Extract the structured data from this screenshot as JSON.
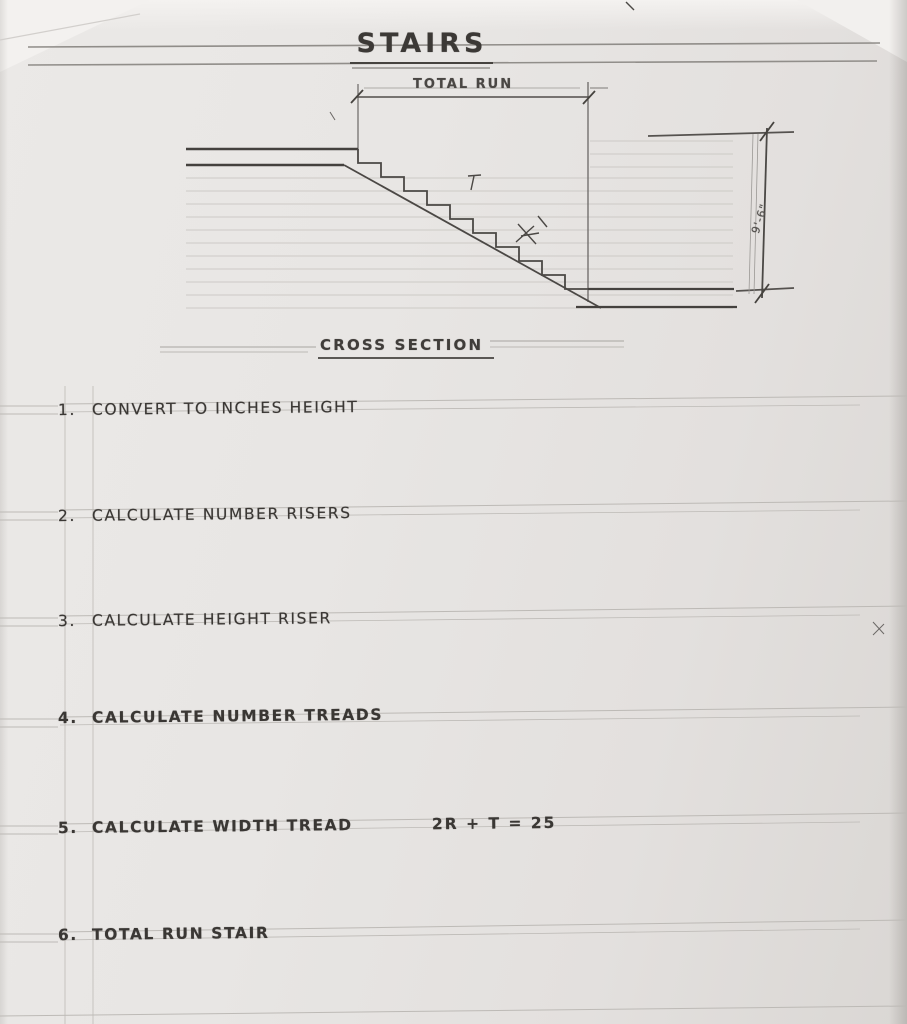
{
  "page": {
    "title": "STAIRS"
  },
  "drawing": {
    "total_run_label": "TOTAL RUN",
    "rise_label": "9'-6\"",
    "caption": "CROSS SECTION"
  },
  "list": {
    "items": [
      {
        "num": "1.",
        "text": "CONVERT TO INCHES HEIGHT"
      },
      {
        "num": "2.",
        "text": "CALCULATE NUMBER RISERS"
      },
      {
        "num": "3.",
        "text": "CALCULATE HEIGHT RISER"
      },
      {
        "num": "4.",
        "text": "CALCULATE NUMBER TREADS"
      },
      {
        "num": "5.",
        "text": "CALCULATE WIDTH TREAD",
        "formula": "2R + T = 25"
      },
      {
        "num": "6.",
        "text": "TOTAL RUN STAIR"
      }
    ]
  },
  "colors": {
    "paper": "#e8e6e4",
    "pencil_dark": "#3a3734",
    "pencil_light": "#6b6866",
    "ruled_line": "#c8c5c1"
  }
}
